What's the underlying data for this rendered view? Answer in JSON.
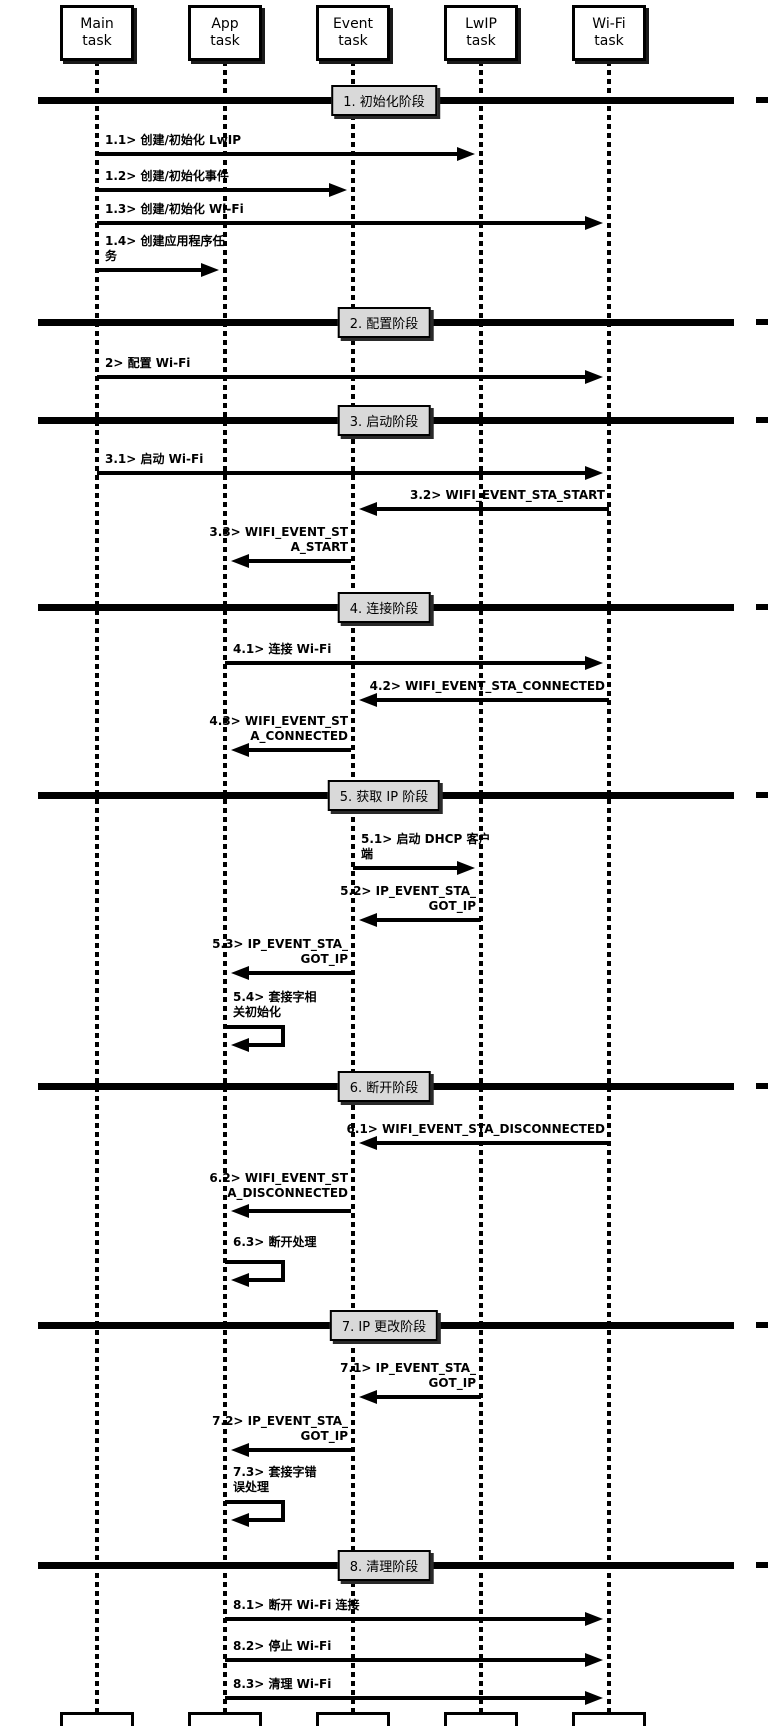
{
  "colors": {
    "background": "#ffffff",
    "line": "#000000",
    "phase_label_bg": "#d9d9d9"
  },
  "tasks": [
    {
      "label": "Main\ntask"
    },
    {
      "label": "App\ntask"
    },
    {
      "label": "Event\ntask"
    },
    {
      "label": "LwIP\ntask"
    },
    {
      "label": "Wi-Fi\ntask"
    }
  ],
  "phases": [
    {
      "label": "1. 初始化阶段"
    },
    {
      "label": "2. 配置阶段"
    },
    {
      "label": "3. 启动阶段"
    },
    {
      "label": "4. 连接阶段"
    },
    {
      "label": "5. 获取 IP 阶段"
    },
    {
      "label": "6. 断开阶段"
    },
    {
      "label": "7. IP 更改阶段"
    },
    {
      "label": "8. 清理阶段"
    }
  ],
  "messages": [
    {
      "text": "1.1> 创建/初始化 LwIP",
      "from": "Main task",
      "to": "LwIP task"
    },
    {
      "text": "1.2> 创建/初始化事件",
      "from": "Main task",
      "to": "Event task"
    },
    {
      "text": "1.3> 创建/初始化 Wi-Fi",
      "from": "Main task",
      "to": "Wi-Fi task"
    },
    {
      "text": "1.4> 创建应用程序任\n务",
      "from": "Main task",
      "to": "App task"
    },
    {
      "text": "2> 配置 Wi-Fi",
      "from": "Main task",
      "to": "Wi-Fi task"
    },
    {
      "text": "3.1> 启动 Wi-Fi",
      "from": "Main task",
      "to": "Wi-Fi task"
    },
    {
      "text": "3.2> WIFI_EVENT_STA_START",
      "from": "Wi-Fi task",
      "to": "Event task"
    },
    {
      "text": "3.3> WIFI_EVENT_ST\nA_START",
      "from": "Event task",
      "to": "App task"
    },
    {
      "text": "4.1> 连接 Wi-Fi",
      "from": "App task",
      "to": "Wi-Fi task"
    },
    {
      "text": "4.2> WIFI_EVENT_STA_CONNECTED",
      "from": "Wi-Fi task",
      "to": "Event task"
    },
    {
      "text": "4.3> WIFI_EVENT_ST\nA_CONNECTED",
      "from": "Event task",
      "to": "App task"
    },
    {
      "text": "5.1> 启动 DHCP 客户\n端",
      "from": "Event task",
      "to": "LwIP task"
    },
    {
      "text": "5.2> IP_EVENT_STA_\nGOT_IP",
      "from": "LwIP task",
      "to": "Event task"
    },
    {
      "text": "5.3> IP_EVENT_STA_\nGOT_IP",
      "from": "Event task",
      "to": "App task"
    },
    {
      "text": "5.4> 套接字相\n关初始化",
      "from": "App task",
      "to": "App task"
    },
    {
      "text": "6.1> WIFI_EVENT_STA_DISCONNECTED",
      "from": "Wi-Fi task",
      "to": "Event task"
    },
    {
      "text": "6.2> WIFI_EVENT_ST\nA_DISCONNECTED",
      "from": "Event task",
      "to": "App task"
    },
    {
      "text": "6.3> 断开处理",
      "from": "App task",
      "to": "App task"
    },
    {
      "text": "7.1> IP_EVENT_STA_\nGOT_IP",
      "from": "LwIP task",
      "to": "Event task"
    },
    {
      "text": "7.2> IP_EVENT_STA_\nGOT_IP",
      "from": "Event task",
      "to": "App task"
    },
    {
      "text": "7.3> 套接字错\n误处理",
      "from": "App task",
      "to": "App task"
    },
    {
      "text": "8.1> 断开 Wi-Fi 连接",
      "from": "App task",
      "to": "Wi-Fi task"
    },
    {
      "text": "8.2> 停止 Wi-Fi",
      "from": "App task",
      "to": "Wi-Fi task"
    },
    {
      "text": "8.3> 清理 Wi-Fi",
      "from": "App task",
      "to": "Wi-Fi task"
    }
  ]
}
